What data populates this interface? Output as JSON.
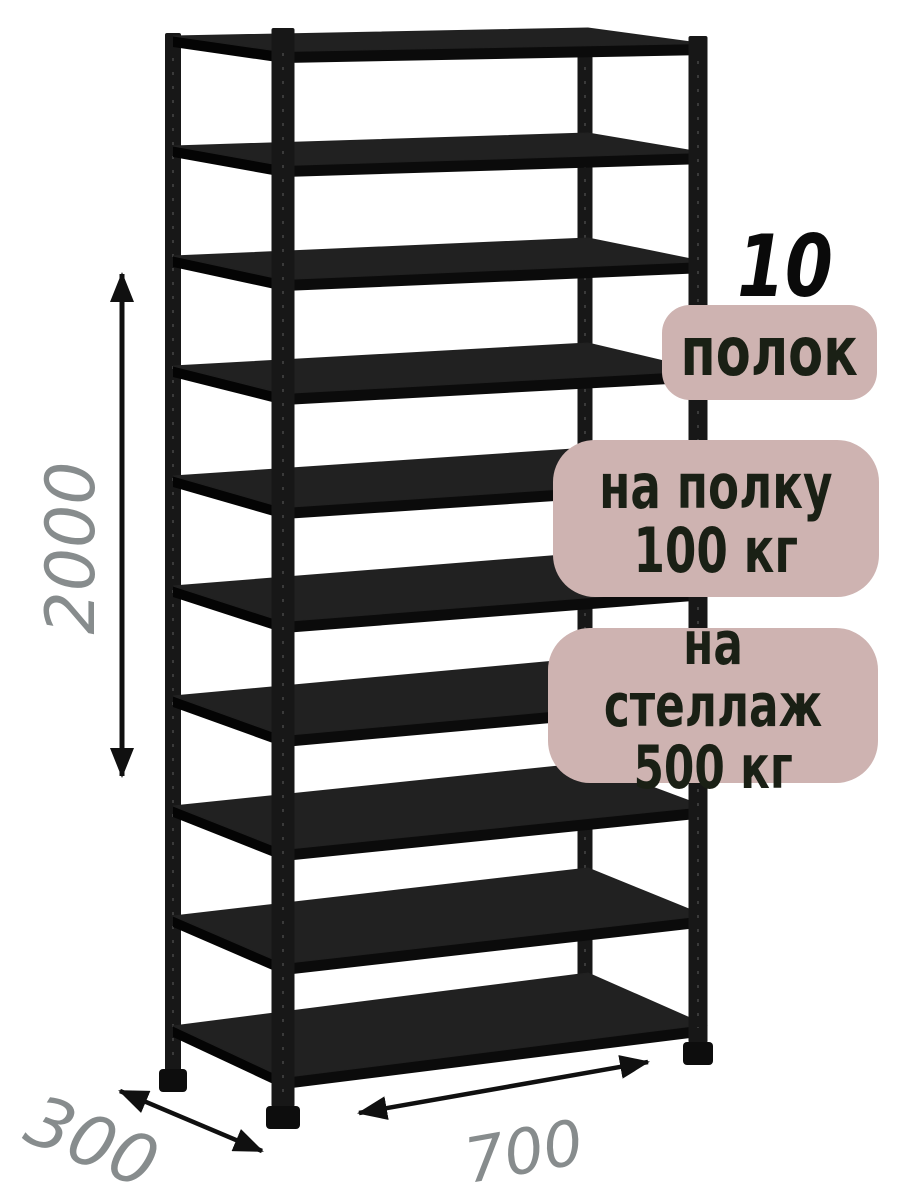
{
  "badges": {
    "count_number": "10",
    "count_label": "полок",
    "shelf_load_line1": "на полку",
    "shelf_load_line2": "100 кг",
    "rack_load_line1": "на стеллаж",
    "rack_load_line2": "500 кг"
  },
  "dimensions": {
    "height_mm": "2000",
    "depth_mm": "300",
    "width_mm": "700"
  },
  "rack": {
    "shelf_count": 10,
    "post_count": 4
  },
  "colors": {
    "background": "#ffffff",
    "badge_background": "#ceb3b1",
    "badge_text": "#1a2015",
    "count_number_text": "#0a0a0a",
    "dimension_text": "#878c8d",
    "arrow": "#101010",
    "rack_metal": "#171717",
    "shelf_top": "#212121",
    "shelf_edge": "#0b0b0b"
  }
}
